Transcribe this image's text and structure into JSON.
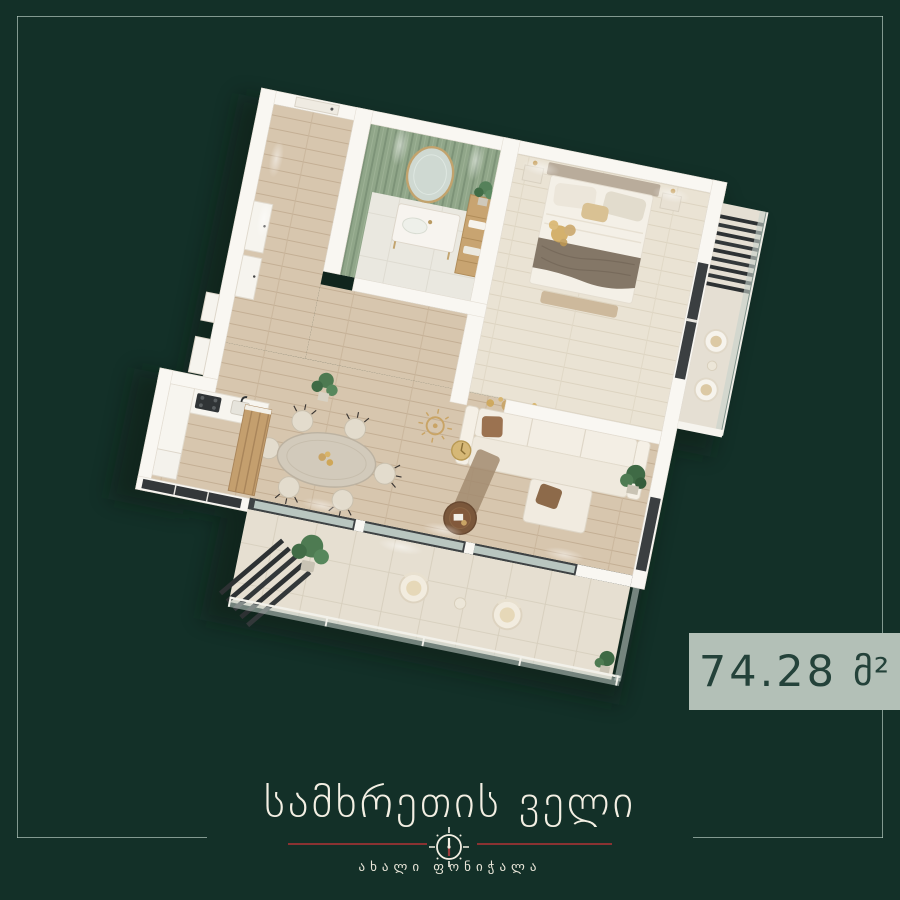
{
  "badge": {
    "value": "74.28",
    "unit": "მ²"
  },
  "footer": {
    "title": "სამხრეთის ველი",
    "subtitle": "ახალი ფონიჭალა"
  },
  "colors": {
    "background": "#133028",
    "frame_line": "#b2c6bc",
    "divider_red": "#8a3232",
    "badge_background": "#b3c0b7",
    "badge_text": "#24423a",
    "title_text": "#f3efe3",
    "wall_white": "#f9f7f2",
    "wood_floor": "#d7c6ae",
    "bathroom_tile_green": "#90a689",
    "accent_gold": "#c9a465",
    "dark_slats": "#2d3133"
  }
}
